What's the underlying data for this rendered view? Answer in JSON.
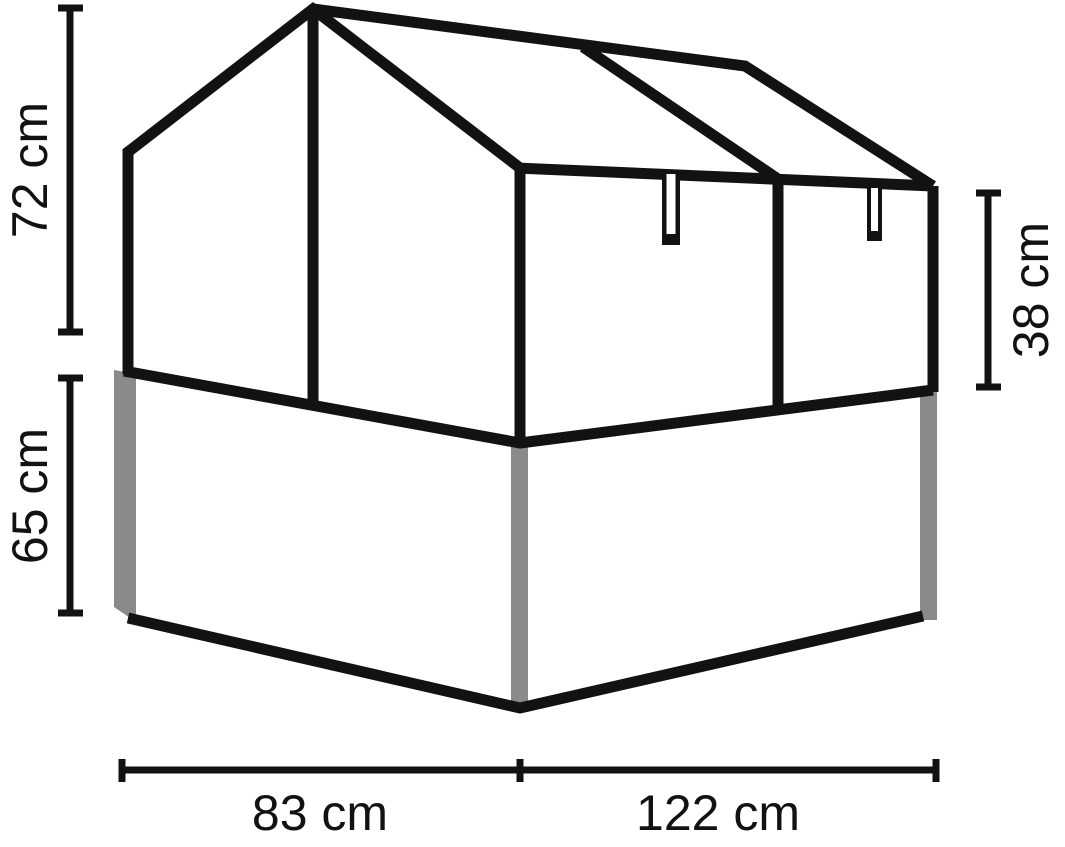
{
  "diagram": {
    "name": "cold-frame-greenhouse-dimension-drawing",
    "colors": {
      "line": "#121212",
      "post": "#8a8a8a",
      "background": "#ffffff"
    },
    "dimensions": {
      "upper_height": {
        "label": "72 cm",
        "value": 72,
        "unit": "cm"
      },
      "bed_height": {
        "label": "65 cm",
        "value": 65,
        "unit": "cm"
      },
      "side_height": {
        "label": "38 cm",
        "value": 38,
        "unit": "cm"
      },
      "depth": {
        "label": "83 cm",
        "value": 83,
        "unit": "cm"
      },
      "width": {
        "label": "122 cm",
        "value": 122,
        "unit": "cm"
      }
    }
  }
}
